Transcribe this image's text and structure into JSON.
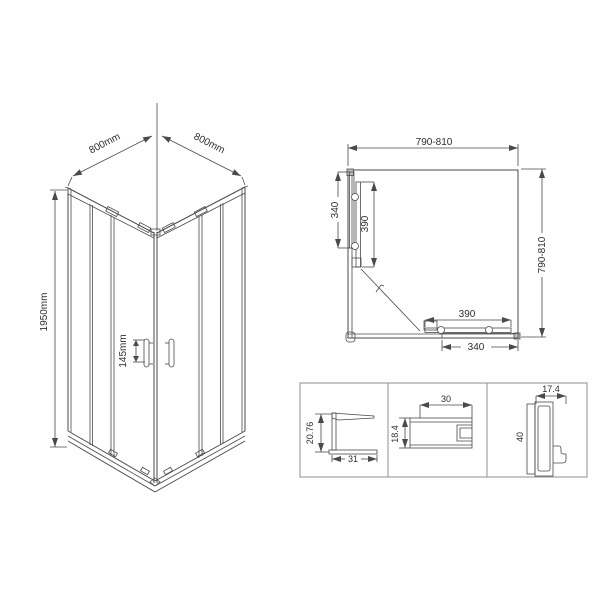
{
  "drawing": {
    "background": "#ffffff",
    "line_color": "#4a4a4a",
    "text_color": "#2e2e2e",
    "iso_view": {
      "width_left": "800mm",
      "width_right": "800mm",
      "height": "1950mm",
      "handle_spacing": "145mm"
    },
    "plan_view": {
      "width": "790-810",
      "depth": "790-810",
      "left_fixed": "340",
      "left_door": "390",
      "bottom_door": "390",
      "bottom_fixed": "340"
    },
    "profiles": {
      "wall": {
        "height": "20.76",
        "width": "31"
      },
      "rail": {
        "width": "30",
        "height": "18.4"
      },
      "frame": {
        "width": "17.4",
        "height": "40"
      }
    }
  }
}
